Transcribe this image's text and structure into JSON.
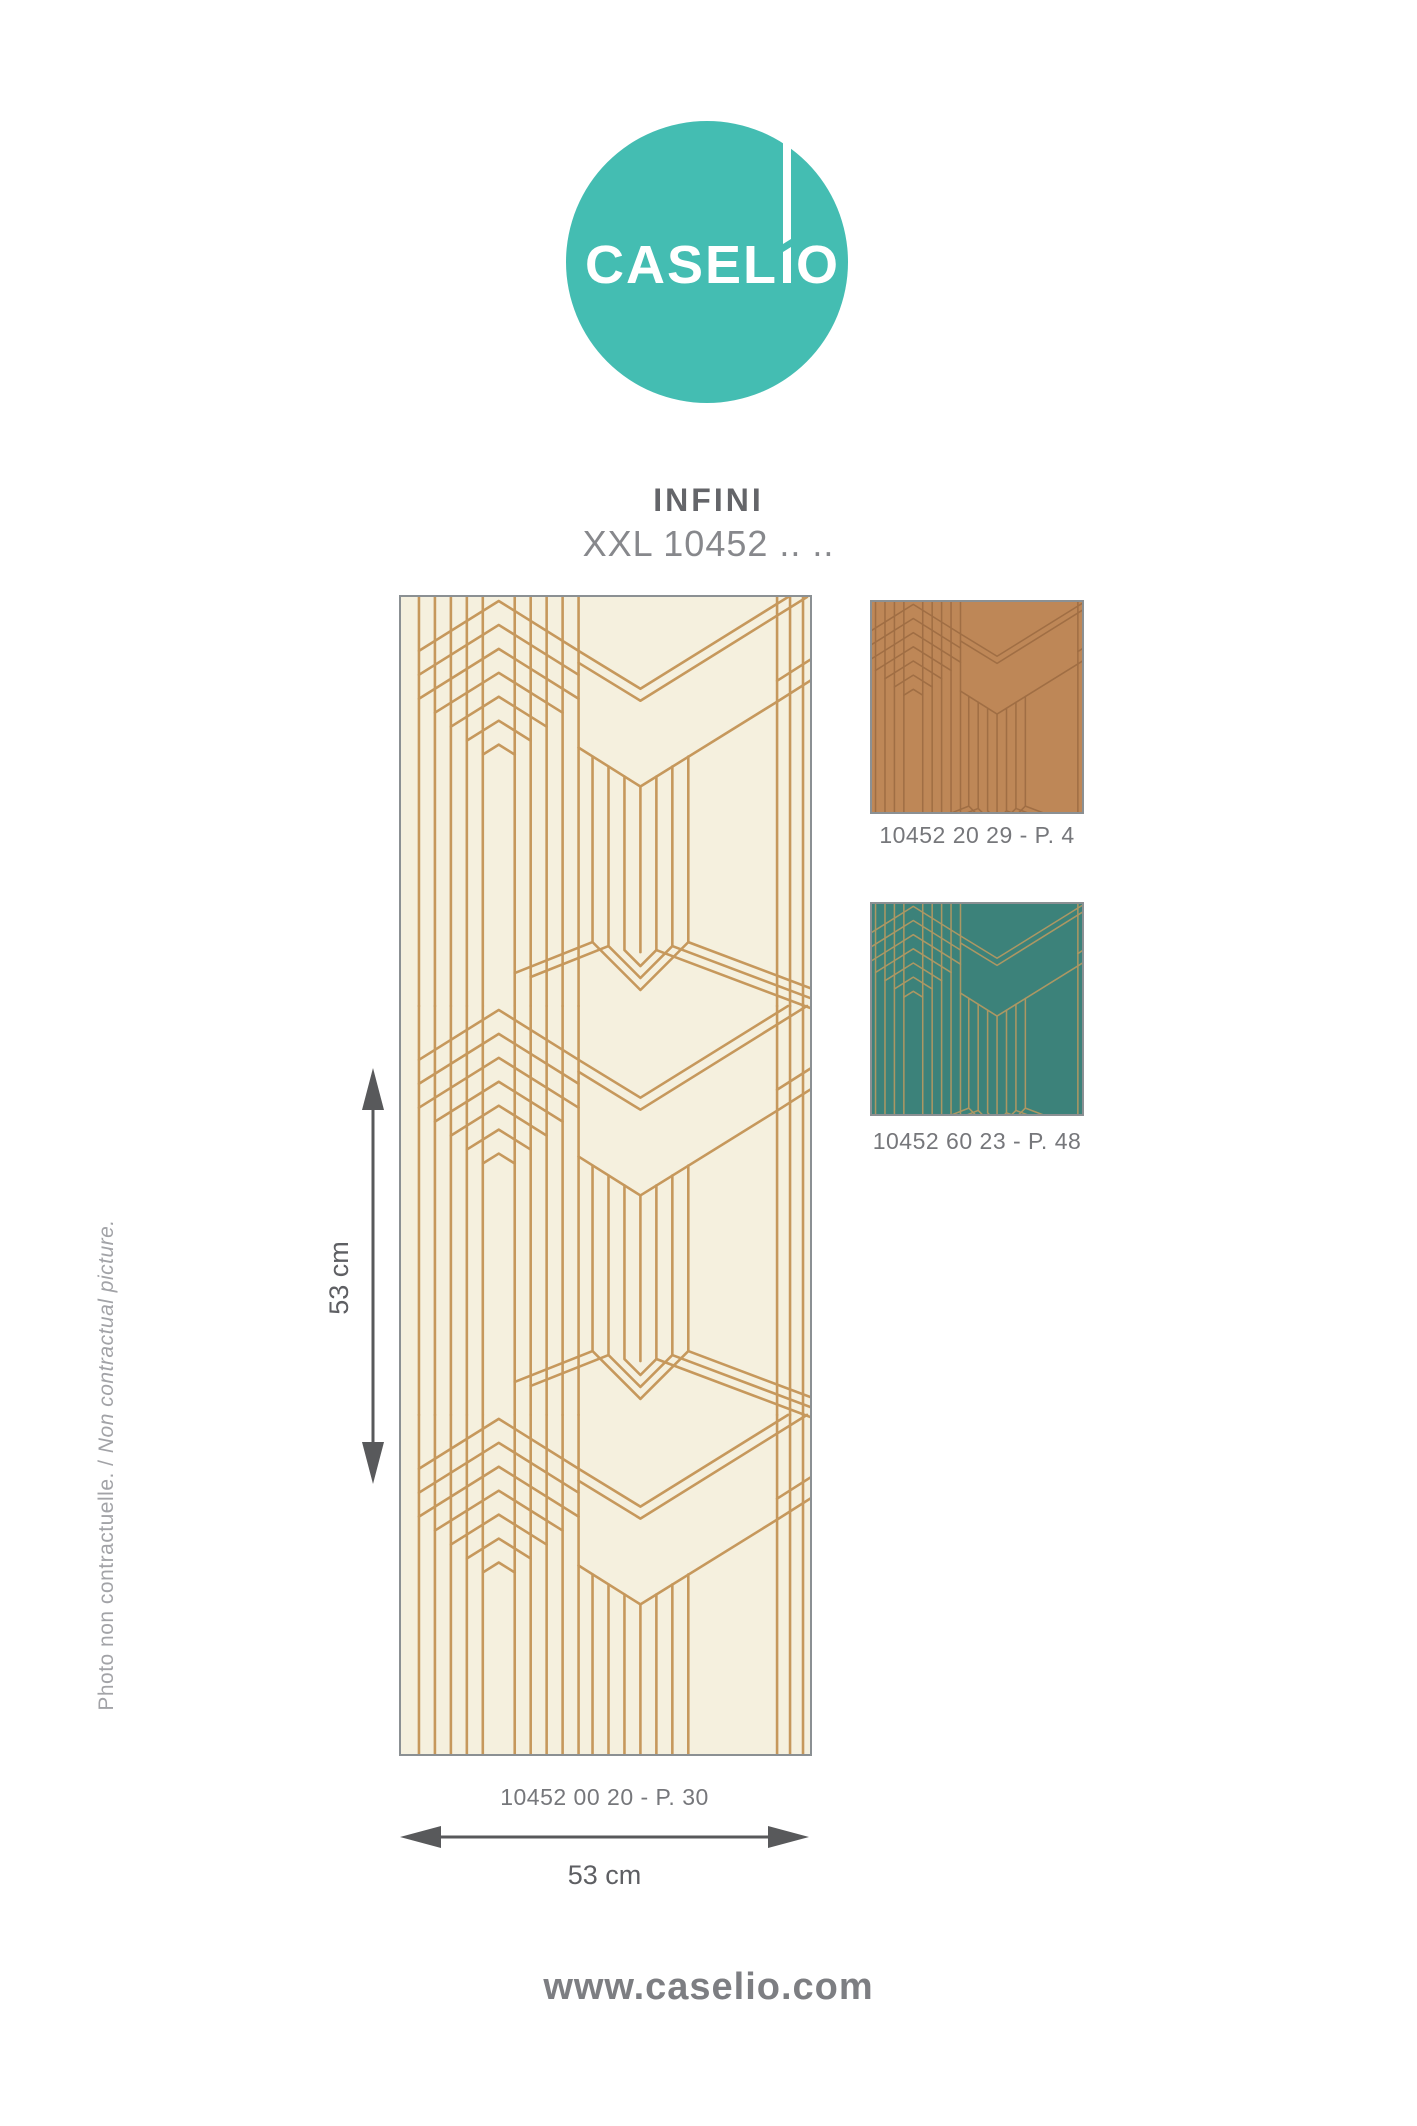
{
  "logo": {
    "text_before_mark": "CASEL",
    "text_after_mark": "O",
    "full_name": "CASELIO",
    "circle_color": "#44BDB2"
  },
  "header": {
    "title": "INFINI",
    "subtitle": "XXL 10452 .. .."
  },
  "main_sample": {
    "reference": "10452 00 20 - P. 30",
    "height_label": "53 cm",
    "width_label": "53 cm",
    "background_color": "#F5F0DE",
    "line_color": "#C6985C"
  },
  "swatches": [
    {
      "reference": "10452 20 29 - P. 4",
      "background_color": "#BE8757",
      "line_color": "#A06E44"
    },
    {
      "reference": "10452 60 23 - P. 48",
      "background_color": "#3C827A",
      "line_color": "#AC9763"
    }
  ],
  "side_note": {
    "text_fr": "Photo non contractuelle. /",
    "text_en": "Non contractual picture."
  },
  "footer": {
    "website": "www.caselio.com"
  }
}
